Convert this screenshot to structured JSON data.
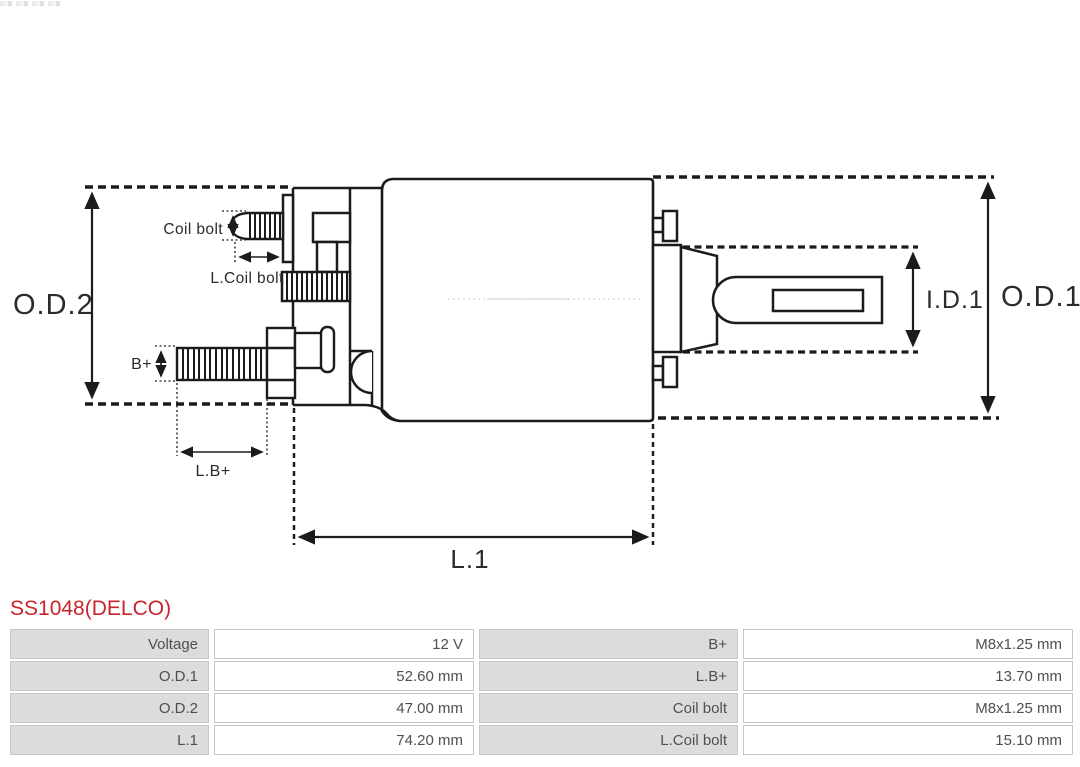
{
  "title": {
    "text": "SS1048(DELCO)",
    "color": "#c9242b"
  },
  "corner_artifact": {
    "colors": [
      "#dfe6ee",
      "#f5efdd",
      "#ccd7e4"
    ]
  },
  "diagram": {
    "line_color": "#1b1b1b",
    "labels": {
      "od2": "O.D.2",
      "od1": "O.D.1",
      "id1": "I.D.1",
      "l1": "L.1",
      "coil_bolt": "Coil bolt",
      "l_coil_bolt": "L.Coil bolt",
      "b_plus": "B+",
      "l_b_plus": "L.B+"
    }
  },
  "table": {
    "label_bg": "#dcdcdc",
    "value_bg": "#ffffff",
    "border_color": "#c8c8c8",
    "text_color": "#4f4f4f",
    "rows": [
      {
        "cells": [
          {
            "label": "Voltage"
          },
          {
            "value": "12 V"
          },
          {
            "label": "B+"
          },
          {
            "value": "M8x1.25 mm"
          }
        ]
      },
      {
        "cells": [
          {
            "label": "O.D.1"
          },
          {
            "value": "52.60 mm"
          },
          {
            "label": "L.B+"
          },
          {
            "value": "13.70 mm"
          }
        ]
      },
      {
        "cells": [
          {
            "label": "O.D.2"
          },
          {
            "value": "47.00 mm"
          },
          {
            "label": "Coil bolt"
          },
          {
            "value": "M8x1.25 mm"
          }
        ]
      },
      {
        "cells": [
          {
            "label": "L.1"
          },
          {
            "value": "74.20 mm"
          },
          {
            "label": "L.Coil bolt"
          },
          {
            "value": "15.10 mm"
          }
        ]
      }
    ]
  }
}
